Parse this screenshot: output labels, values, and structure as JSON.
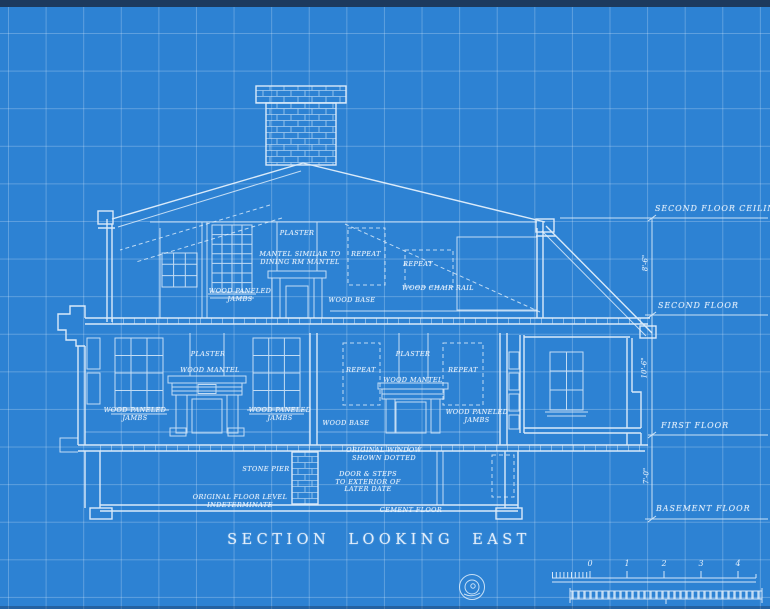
{
  "title": "SECTION LOOKING EAST",
  "colors": {
    "paper": "#2d82d3",
    "line": "#e8f3fd",
    "top_strip": "#1d3a5e"
  },
  "drawing": {
    "attic": {
      "plaster": "PLASTER",
      "mantel_note": "MANTEL SIMILAR TO\nDINING RM MANTEL",
      "repeat_left": "REPEAT",
      "repeat_right": "REPEAT",
      "wood_paneled_jambs": "WOOD PANELED\nJAMBS",
      "wood_base": "WOOD BASE",
      "wood_chair_rail": "WOOD CHAIR RAIL"
    },
    "first_floor": {
      "plaster_left": "PLASTER",
      "wood_mantel_left": "WOOD MANTEL",
      "jambs_left": "WOOD PANELED\nJAMBS",
      "jambs_center": "WOOD PANELED\nJAMBS",
      "plaster_right": "PLASTER",
      "repeat_left": "REPEAT",
      "repeat_right": "REPEAT",
      "wood_mantel_right": "WOOD MANTEL",
      "wood_base": "WOOD BASE",
      "jambs_right": "WOOD PANELED\nJAMBS"
    },
    "basement": {
      "stone_pier": "STONE PIER",
      "original_window": "ORIGINAL WINDOW\nSHOWN DOTTED",
      "door_note": "DOOR & STEPS\nTO EXTERIOR OF\nLATER DATE",
      "original_floor": "ORIGINAL FLOOR LEVEL\nINDETERMINATE",
      "cement_floor": "CEMENT FLOOR"
    }
  },
  "annotations": {
    "second_floor_ceiling": "SECOND FLOOR CEILING",
    "second_floor": "SECOND FLOOR",
    "first_floor": "FIRST FLOOR",
    "basement_floor": "BASEMENT FLOOR",
    "dim_attic": "8'-6\"",
    "dim_first": "10'-6\"",
    "dim_basement": "7'-0\""
  },
  "scale_bar": {
    "numbers": [
      "0",
      "1",
      "2",
      "3",
      "4"
    ]
  }
}
